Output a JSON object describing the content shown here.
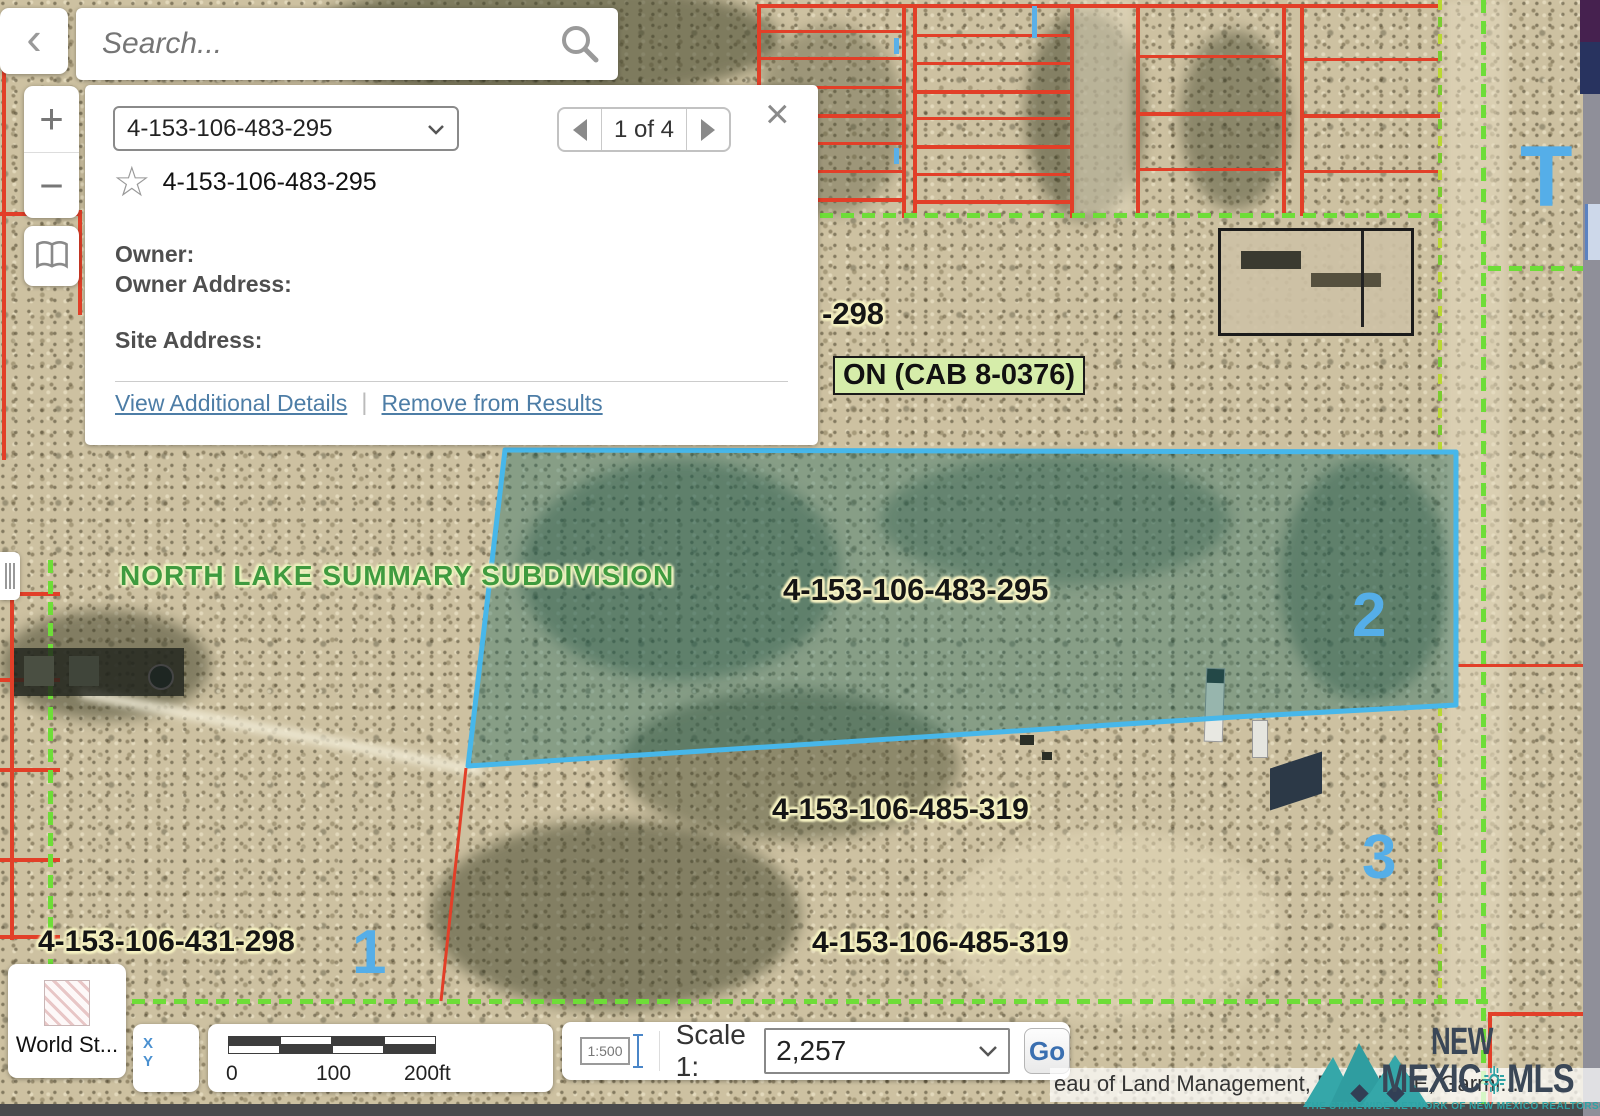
{
  "search": {
    "placeholder": "Search..."
  },
  "icons": {
    "back": "‹",
    "zoom_in": "+",
    "zoom_out": "−",
    "close": "×",
    "star": "☆",
    "separator": "|"
  },
  "results_panel": {
    "selected_parcel": "4-153-106-483-295",
    "pagination": "1 of 4",
    "starred_parcel": "4-153-106-483-295",
    "owner_label": "Owner:",
    "owner_address_label": "Owner Address:",
    "site_address_label": "Site Address:",
    "view_details_link": "View Additional Details",
    "remove_link": "Remove from Results"
  },
  "map": {
    "subdivision_label": "NORTH LAKE SUMMARY SUBDIVISION",
    "cab_label": "ON (CAB 8-0376)",
    "parcel_298": "-298",
    "parcel_483": "4-153-106-483-295",
    "parcel_485_a": "4-153-106-485-319",
    "parcel_485_b": "4-153-106-485-319",
    "parcel_431": "4-153-106-431-298",
    "lot_1": "1",
    "lot_2": "2",
    "lot_3": "3",
    "letter_t": "T",
    "edge_label": "or"
  },
  "basemap_button": {
    "label": "World St..."
  },
  "scalebar": {
    "tick_0": "0",
    "tick_100": "100",
    "tick_200": "200ft"
  },
  "scale_widget": {
    "icon_label": "1:500",
    "label": "Scale 1:",
    "value": "2,257",
    "go_label": "Go"
  },
  "attribution": {
    "text": "eau of Land Management, Esri, HERE, Garmi..."
  },
  "logo": {
    "line1": "NEW",
    "line2_left": "MEXIC",
    "line2_right": "MLS",
    "tagline": "THE STATEWIDE NETWORK OF NEW MEXICO REALTORS®"
  },
  "colors": {
    "selection_outline": "#47b7ea",
    "selection_fill": "rgba(30,105,95,0.40)",
    "parcel_line_red": "#e23f28",
    "boundary_green": "#6edd38",
    "link_blue": "#4d7da6",
    "number_blue": "#55aee8"
  }
}
